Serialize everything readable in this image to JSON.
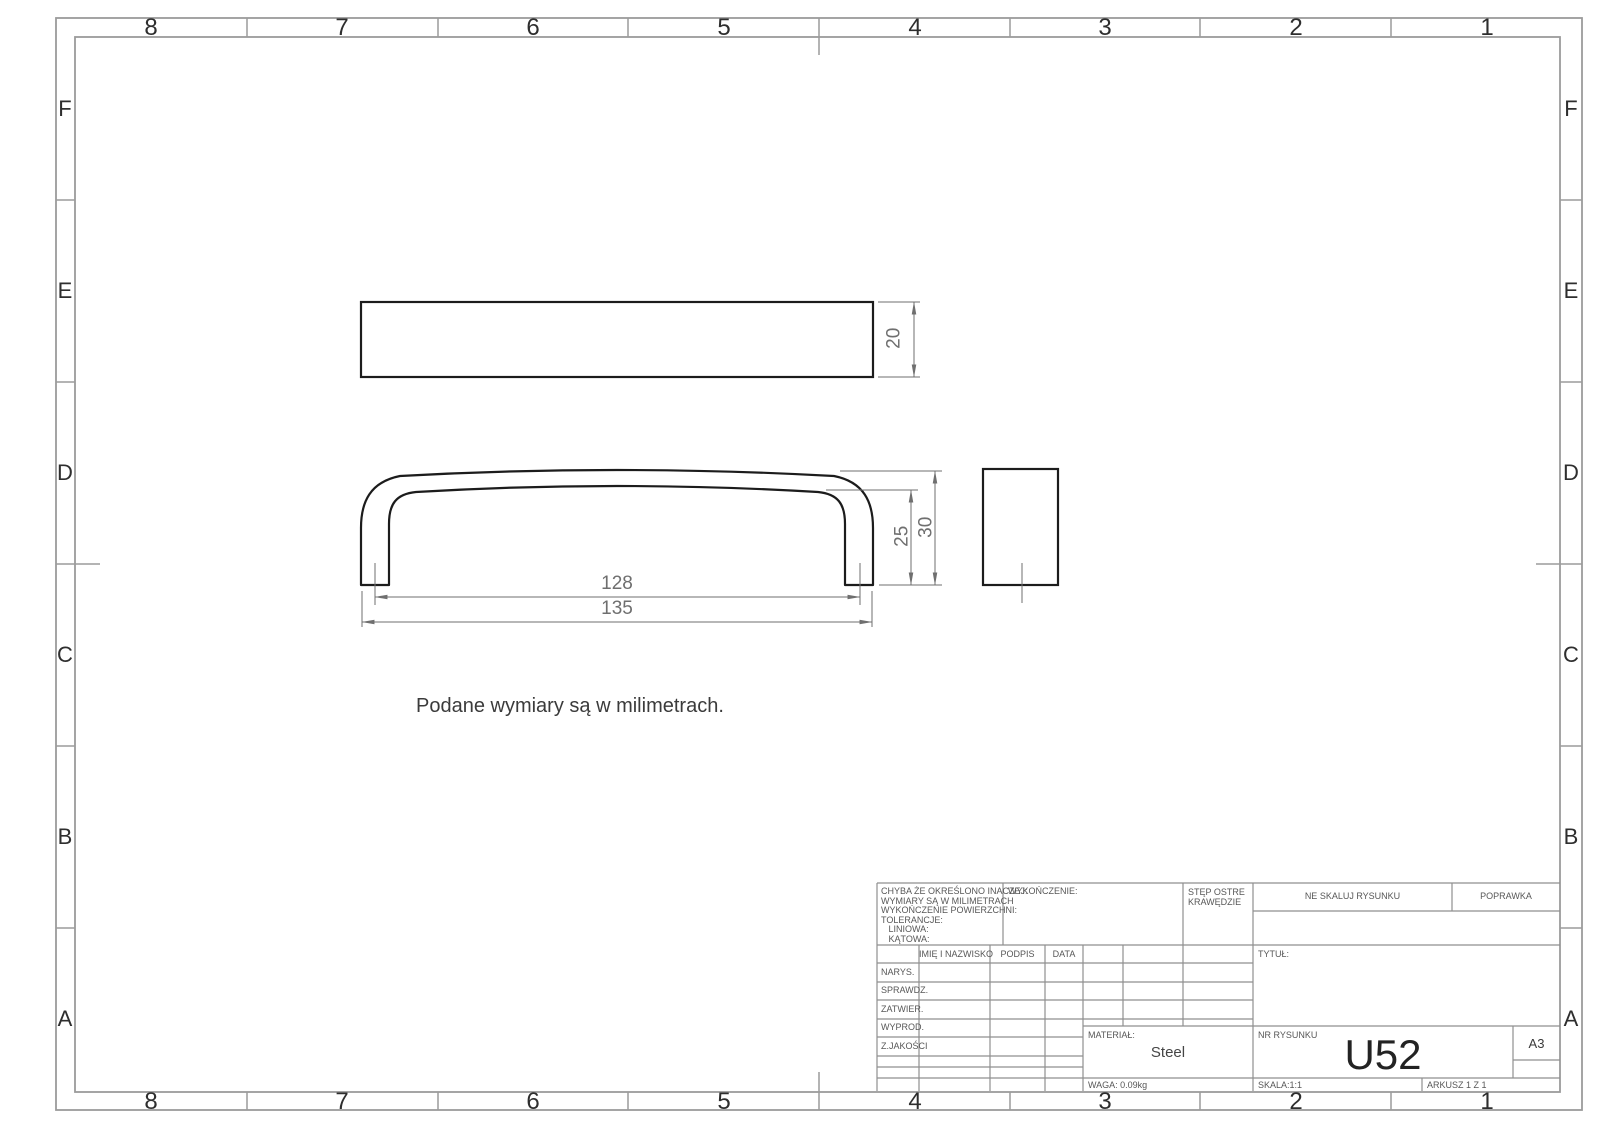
{
  "sheet": {
    "zone_columns": [
      "8",
      "7",
      "6",
      "5",
      "4",
      "3",
      "2",
      "1"
    ],
    "zone_rows": [
      "F",
      "E",
      "D",
      "C",
      "B",
      "A"
    ],
    "note": "Podane wymiary są w milimetrach."
  },
  "drawing": {
    "dim_top_view_height": "20",
    "dim_inner_height": "25",
    "dim_overall_height": "30",
    "dim_hole_spacing": "128",
    "dim_overall_length": "135"
  },
  "title_block": {
    "tolerance_note": "CHYBA ŻE OKREŚLONO INACZEJ:\nWYMIARY SĄ W MILIMETRACH\nWYKOŃCZENIE POWIERZCHNI:\nTOLERANCJE:\n   LINIOWA:\n   KĄTOWA:",
    "finish_label": "WYKOŃCZENIE:",
    "edges_note": "STĘP OSTRE\nKRAWĘDZIE",
    "do_not_scale": "NE SKALUJ RYSUNKU",
    "revision_label": "POPRAWKA",
    "col_name": "IMIĘ I NAZWISKO",
    "col_signature": "PODPIS",
    "col_date": "DATA",
    "row_drawn": "NARYS.",
    "row_checked": "SPRAWDZ.",
    "row_approved": "ZATWIER.",
    "row_manufactured": "WYPROD.",
    "row_quality": "Z.JAKOŚCI",
    "title_label": "TYTUŁ:",
    "material_label": "MATERIAŁ:",
    "material_value": "Steel",
    "weight": "WAGA: 0.09kg",
    "drawing_number_label": "NR RYSUNKU",
    "drawing_number": "U52",
    "paper_size": "A3",
    "scale": "SKALA:1:1",
    "sheet_number": "ARKUSZ 1 Z 1"
  },
  "colors": {
    "border": "#9b9b9b",
    "grid": "#8f8f8f",
    "part_line": "#1c1c1c",
    "dimension": "#6f6f6f"
  }
}
